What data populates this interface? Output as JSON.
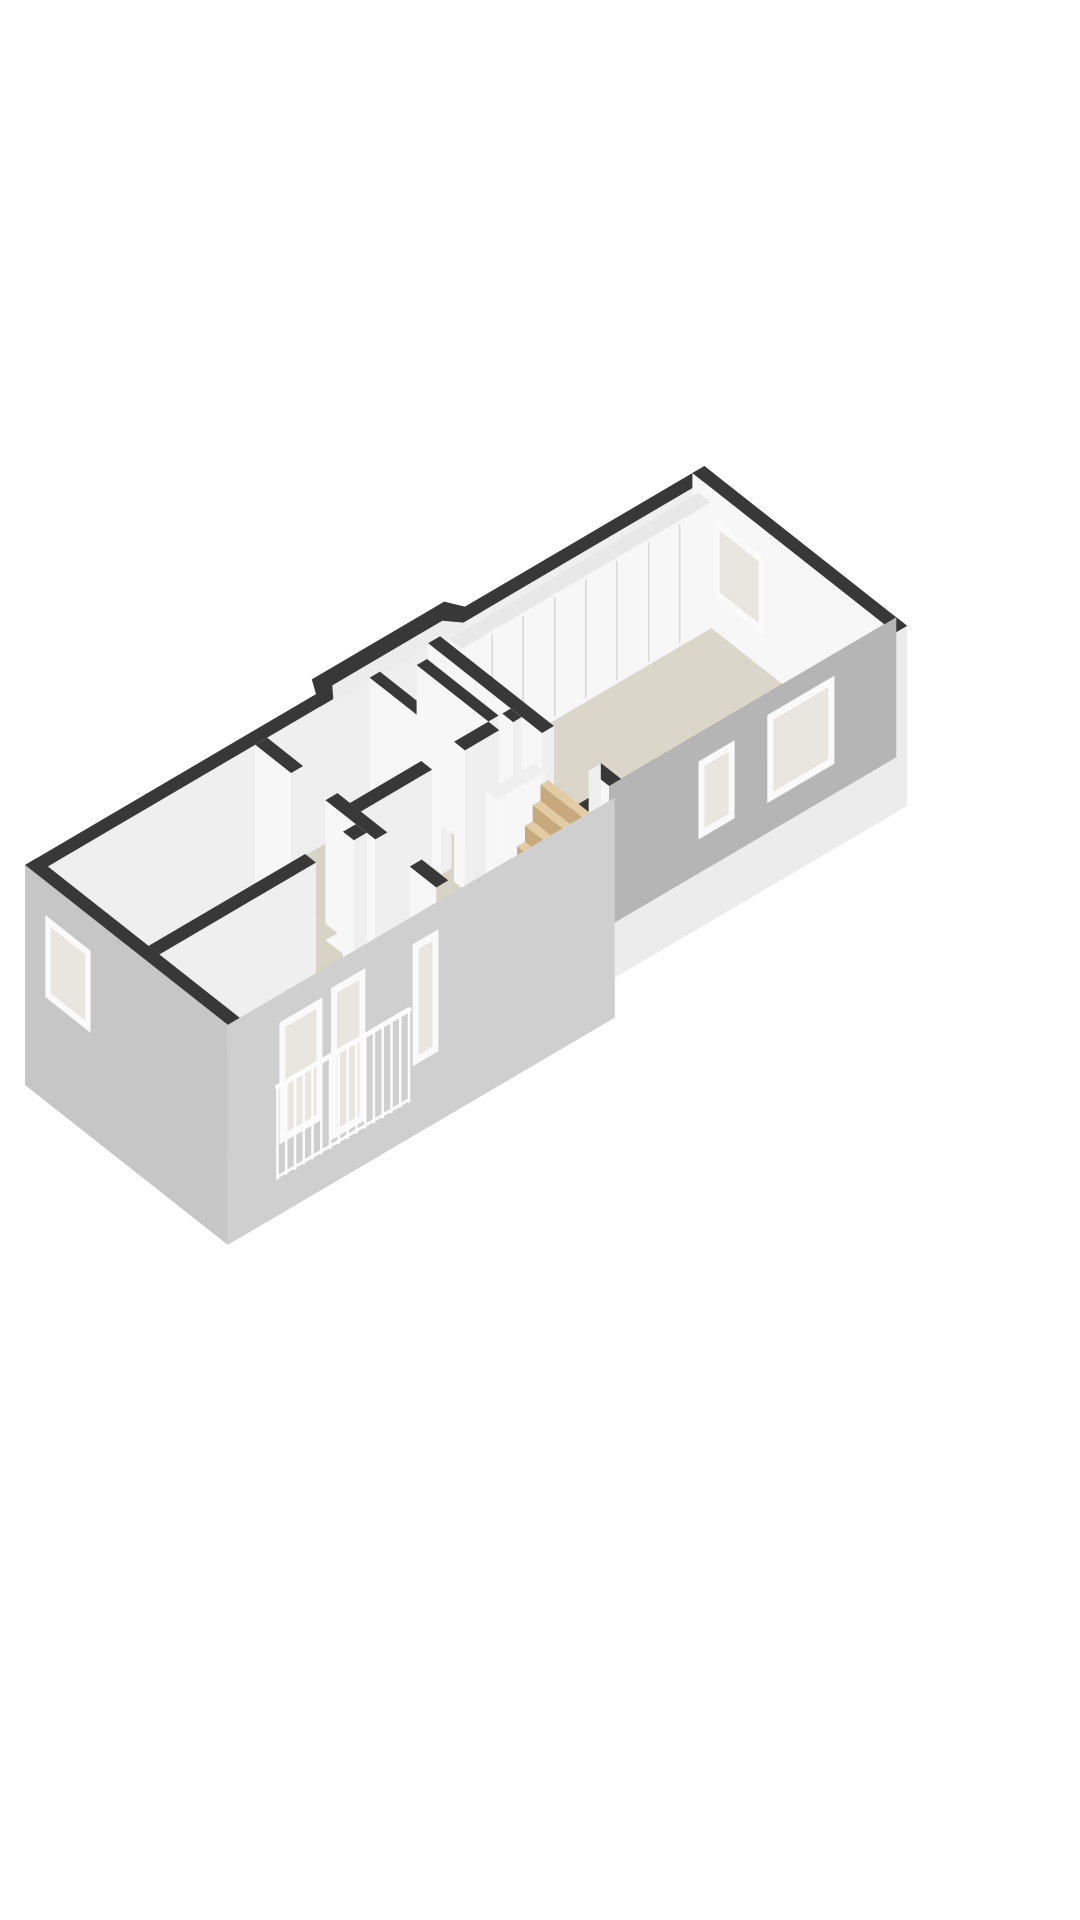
{
  "canvas": {
    "width": 1080,
    "height": 1920,
    "background": "#ffffff"
  },
  "scene": {
    "description": "3d-isometric-floorplan-render",
    "projection": {
      "ox": 25,
      "oy": 1005,
      "ux": 0.86,
      "uy": -0.505,
      "vx": 0.78,
      "vy": 0.615
    },
    "wallHeight": 140,
    "colors": {
      "wallTop": "#383838",
      "whiteA": "#f7f7f7",
      "whiteB": "#efefef",
      "grayIn": "#b5b5b5",
      "outSE": "#cfcfcf",
      "outSW": "#c6c6c6",
      "outLight": "#ececec",
      "floor": "#d7d3c5",
      "floorNE": "#dad6c9",
      "closetTop": "#e8e8e8",
      "landing": "#efefef",
      "seam": "#d8d8d8",
      "frame": "#fafafa",
      "glass": "#e8e6df",
      "stepTop": "#e3cba4",
      "stepFace": "#c8a87d",
      "stepSide": "#bfa077",
      "railing": "#fcfcfc"
    },
    "elements": [
      {
        "name": "nw-facade-wall",
        "t": "box",
        "x": [
          0,
          790
        ],
        "y": [
          0,
          14
        ],
        "faces": [
          {
            "side": "top",
            "c": "wallTop"
          },
          {
            "side": "ymax",
            "c": "whiteB"
          }
        ]
      },
      {
        "name": "bay-window-top",
        "t": "poly",
        "h": 140,
        "c": "wallTop",
        "pts": [
          [
            330,
            14
          ],
          [
            348,
            -16
          ],
          [
            502,
            -16
          ],
          [
            520,
            14
          ]
        ]
      },
      {
        "name": "bay-window-interior",
        "t": "poly",
        "h": 136,
        "c": "outLight",
        "pts": [
          [
            346,
            14
          ],
          [
            360,
            -3
          ],
          [
            488,
            -3
          ],
          [
            504,
            14
          ]
        ]
      },
      {
        "name": "ne-end-wall",
        "t": "box",
        "x": [
          776,
          790
        ],
        "y": [
          0,
          260
        ],
        "faces": [
          {
            "side": "top",
            "c": "wallTop"
          },
          {
            "side": "xmin",
            "c": "whiteA"
          }
        ]
      },
      {
        "name": "ne-room-floor",
        "t": "poly",
        "h": 0,
        "c": "floorNE",
        "pts": [
          [
            470,
            14
          ],
          [
            776,
            14
          ],
          [
            776,
            246
          ],
          [
            470,
            246
          ]
        ]
      },
      {
        "name": "closet-wall",
        "t": "box",
        "x": [
          480,
          770
        ],
        "y": [
          14,
          30
        ],
        "h": [
          6,
          132
        ],
        "faces": [
          {
            "side": "top",
            "c": "closetTop"
          },
          {
            "side": "xmin",
            "c": "whiteA"
          },
          {
            "side": "ymax",
            "c": "whiteA"
          }
        ]
      },
      {
        "name": "closet-door-seams",
        "t": "lines",
        "plane": "ymax",
        "at": 30,
        "us": [
          516,
          552,
          589,
          625,
          661,
          698,
          734
        ],
        "h": [
          10,
          128
        ],
        "c": "seam",
        "w": 1.5
      },
      {
        "name": "ne-end-window",
        "t": "win",
        "plane": "xmin",
        "at": 776,
        "u": [
          28,
          92
        ],
        "h": [
          34,
          112
        ]
      },
      {
        "name": "se-facade-top",
        "t": "poly",
        "h": 140,
        "c": "wallTop",
        "pts": [
          [
            0,
            246
          ],
          [
            790,
            246
          ],
          [
            790,
            260
          ],
          [
            0,
            260
          ]
        ]
      },
      {
        "name": "se-facade-ne-outer",
        "t": "box",
        "x": [
          450,
          790
        ],
        "y": [
          246,
          260
        ],
        "h": [
          -40,
          140
        ],
        "faces": [
          {
            "side": "ymax",
            "c": "outLight"
          }
        ]
      },
      {
        "name": "se-facade-ne-inner",
        "t": "box",
        "x": [
          450,
          790
        ],
        "y": [
          246,
          260
        ],
        "faces": [
          {
            "side": "ymin",
            "c": "grayIn",
            "h": [
              0,
              140
            ]
          }
        ]
      },
      {
        "name": "se-inner-window-large",
        "t": "win",
        "plane": "ymin",
        "at": 246,
        "u": [
          640,
          718
        ],
        "h": [
          30,
          118
        ]
      },
      {
        "name": "se-inner-window-small",
        "t": "win",
        "plane": "ymin",
        "at": 246,
        "u": [
          560,
          602
        ],
        "h": [
          34,
          112
        ]
      },
      {
        "name": "ne-room-partition-a",
        "t": "box",
        "x": [
          456,
          470
        ],
        "y": [
          14,
          160
        ],
        "faces": [
          {
            "side": "top",
            "c": "wallTop"
          },
          {
            "side": "xmin",
            "c": "whiteA"
          },
          {
            "side": "ymax",
            "c": "whiteB"
          }
        ]
      },
      {
        "name": "ne-room-partition-b",
        "t": "box",
        "x": [
          456,
          470
        ],
        "y": [
          220,
          246
        ],
        "faces": [
          {
            "side": "top",
            "c": "wallTop"
          },
          {
            "side": "xmin",
            "c": "whiteA"
          },
          {
            "side": "ymin",
            "c": "whiteB"
          }
        ]
      },
      {
        "name": "ne-room-door-threshold",
        "t": "poly",
        "h": 0,
        "c": "floorNE",
        "pts": [
          [
            456,
            160
          ],
          [
            470,
            160
          ],
          [
            470,
            220
          ],
          [
            456,
            220
          ]
        ]
      },
      {
        "name": "middle-floor",
        "t": "poly",
        "h": 0,
        "c": "floor",
        "pts": [
          [
            269,
            14
          ],
          [
            456,
            14
          ],
          [
            456,
            246
          ],
          [
            269,
            246
          ]
        ]
      },
      {
        "name": "bathroom-partition-a",
        "t": "box",
        "x": [
          388,
          400
        ],
        "y": [
          14,
          106
        ],
        "faces": [
          {
            "side": "top",
            "c": "wallTop"
          },
          {
            "side": "xmin",
            "c": "whiteA"
          },
          {
            "side": "ymax",
            "c": "whiteB"
          }
        ]
      },
      {
        "name": "bathroom-partition-b",
        "t": "box",
        "x": [
          430,
          442
        ],
        "y": [
          28,
          120
        ],
        "faces": [
          {
            "side": "top",
            "c": "wallTop"
          },
          {
            "side": "xmin",
            "c": "whiteA"
          },
          {
            "side": "ymax",
            "c": "whiteB"
          }
        ]
      },
      {
        "name": "hall-partition-a",
        "t": "box",
        "x": [
          269,
          352
        ],
        "y": [
          120,
          134
        ],
        "faces": [
          {
            "side": "top",
            "c": "wallTop"
          },
          {
            "side": "ymax",
            "c": "whiteB"
          }
        ]
      },
      {
        "name": "hall-partition-b",
        "t": "box",
        "x": [
          390,
          430
        ],
        "y": [
          120,
          134
        ],
        "faces": [
          {
            "side": "top",
            "c": "wallTop"
          },
          {
            "side": "ymax",
            "c": "whiteB"
          },
          {
            "side": "xmin",
            "c": "whiteA"
          }
        ]
      },
      {
        "name": "hall-partition-c",
        "t": "box",
        "x": [
          446,
          456
        ],
        "y": [
          120,
          134
        ],
        "faces": [
          {
            "side": "top",
            "c": "wallTop"
          },
          {
            "side": "ymax",
            "c": "whiteB"
          },
          {
            "side": "xmin",
            "c": "whiteA"
          }
        ]
      },
      {
        "name": "hall-door-threshold-a",
        "t": "poly",
        "h": 0,
        "c": "floor",
        "pts": [
          [
            352,
            120
          ],
          [
            390,
            120
          ],
          [
            390,
            134
          ],
          [
            352,
            134
          ]
        ]
      },
      {
        "name": "hall-door-threshold-b",
        "t": "poly",
        "h": 0,
        "c": "floor",
        "pts": [
          [
            430,
            120
          ],
          [
            446,
            120
          ],
          [
            446,
            134
          ],
          [
            430,
            134
          ]
        ]
      },
      {
        "name": "stair-balustrade",
        "t": "box",
        "x": [
          400,
          456
        ],
        "y": [
          150,
          164
        ],
        "h": [
          0,
          104
        ],
        "faces": [
          {
            "side": "top",
            "c": "landing"
          },
          {
            "side": "xmin",
            "c": "whiteA"
          },
          {
            "side": "ymax",
            "c": "whiteA"
          }
        ]
      },
      {
        "name": "stair-step-6",
        "t": "box",
        "x": [
          447,
          456
        ],
        "y": [
          168,
          242
        ],
        "h": [
          0,
          98
        ],
        "faces": [
          {
            "side": "top",
            "c": "stepTop"
          },
          {
            "side": "xmin",
            "c": "stepFace"
          },
          {
            "side": "ymax",
            "c": "stepSide"
          }
        ]
      },
      {
        "name": "stair-step-5",
        "t": "box",
        "x": [
          438,
          447
        ],
        "y": [
          168,
          242
        ],
        "h": [
          0,
          82
        ],
        "faces": [
          {
            "side": "top",
            "c": "stepTop"
          },
          {
            "side": "xmin",
            "c": "stepFace"
          },
          {
            "side": "ymax",
            "c": "stepSide"
          }
        ]
      },
      {
        "name": "stair-step-4",
        "t": "box",
        "x": [
          429,
          438
        ],
        "y": [
          168,
          242
        ],
        "h": [
          0,
          66
        ],
        "faces": [
          {
            "side": "top",
            "c": "stepTop"
          },
          {
            "side": "xmin",
            "c": "stepFace"
          },
          {
            "side": "ymax",
            "c": "stepSide"
          }
        ]
      },
      {
        "name": "stair-step-3",
        "t": "box",
        "x": [
          420,
          429
        ],
        "y": [
          168,
          242
        ],
        "h": [
          0,
          50
        ],
        "faces": [
          {
            "side": "top",
            "c": "stepTop"
          },
          {
            "side": "xmin",
            "c": "stepFace"
          },
          {
            "side": "ymax",
            "c": "stepSide"
          }
        ]
      },
      {
        "name": "stair-step-2",
        "t": "box",
        "x": [
          411,
          420
        ],
        "y": [
          168,
          242
        ],
        "h": [
          0,
          34
        ],
        "faces": [
          {
            "side": "top",
            "c": "stepTop"
          },
          {
            "side": "xmin",
            "c": "stepFace"
          },
          {
            "side": "ymax",
            "c": "stepSide"
          }
        ]
      },
      {
        "name": "stair-step-1",
        "t": "box",
        "x": [
          402,
          411
        ],
        "y": [
          168,
          242
        ],
        "h": [
          0,
          18
        ],
        "faces": [
          {
            "side": "top",
            "c": "stepTop"
          },
          {
            "side": "xmin",
            "c": "stepFace"
          },
          {
            "side": "ymax",
            "c": "stepSide"
          }
        ]
      },
      {
        "name": "sw-partition-a",
        "t": "box",
        "x": [
          255,
          269
        ],
        "y": [
          14,
          60
        ],
        "faces": [
          {
            "side": "top",
            "c": "wallTop"
          },
          {
            "side": "xmin",
            "c": "whiteA"
          },
          {
            "side": "ymax",
            "c": "whiteB"
          }
        ]
      },
      {
        "name": "sw-partition-b",
        "t": "box",
        "x": [
          255,
          269
        ],
        "y": [
          104,
          168
        ],
        "faces": [
          {
            "side": "top",
            "c": "wallTop"
          },
          {
            "side": "xmin",
            "c": "whiteA"
          },
          {
            "side": "ymax",
            "c": "whiteB"
          }
        ]
      },
      {
        "name": "sw-partition-c",
        "t": "box",
        "x": [
          255,
          269
        ],
        "y": [
          212,
          246
        ],
        "faces": [
          {
            "side": "top",
            "c": "wallTop"
          },
          {
            "side": "xmin",
            "c": "whiteA"
          }
        ]
      },
      {
        "name": "sw-door-threshold-a",
        "t": "poly",
        "h": 0,
        "c": "floor",
        "pts": [
          [
            255,
            60
          ],
          [
            269,
            60
          ],
          [
            269,
            104
          ],
          [
            255,
            104
          ]
        ]
      },
      {
        "name": "sw-door-threshold-b",
        "t": "poly",
        "h": 0,
        "c": "floor",
        "pts": [
          [
            255,
            168
          ],
          [
            269,
            168
          ],
          [
            269,
            212
          ],
          [
            255,
            212
          ]
        ]
      },
      {
        "name": "sw-floor",
        "t": "poly",
        "h": 0,
        "c": "floor",
        "pts": [
          [
            14,
            14
          ],
          [
            255,
            14
          ],
          [
            255,
            246
          ],
          [
            14,
            246
          ]
        ]
      },
      {
        "name": "bedroom-partition-a",
        "t": "box",
        "x": [
          14,
          196
        ],
        "y": [
          143,
          157
        ],
        "faces": [
          {
            "side": "top",
            "c": "wallTop"
          },
          {
            "side": "ymax",
            "c": "whiteB"
          }
        ]
      },
      {
        "name": "bedroom-partition-b",
        "t": "box",
        "x": [
          240,
          255
        ],
        "y": [
          143,
          157
        ],
        "faces": [
          {
            "side": "top",
            "c": "wallTop"
          },
          {
            "side": "ymax",
            "c": "whiteB"
          },
          {
            "side": "xmin",
            "c": "whiteA"
          }
        ]
      },
      {
        "name": "bedroom-door-threshold",
        "t": "poly",
        "h": 0,
        "c": "floor",
        "pts": [
          [
            196,
            143
          ],
          [
            240,
            143
          ],
          [
            240,
            157
          ],
          [
            196,
            157
          ]
        ]
      },
      {
        "name": "se-facade-sw-outer",
        "t": "box",
        "x": [
          0,
          450
        ],
        "y": [
          246,
          260
        ],
        "h": [
          -80,
          140
        ],
        "faces": [
          {
            "side": "ymax",
            "c": "outSE"
          }
        ]
      },
      {
        "name": "facade-window-a",
        "t": "win",
        "plane": "ymax",
        "at": 260,
        "u": [
          60,
          110
        ],
        "h": [
          -10,
          112
        ]
      },
      {
        "name": "facade-door",
        "t": "win",
        "plane": "ymax",
        "at": 260,
        "u": [
          120,
          160
        ],
        "h": [
          -36,
          116
        ]
      },
      {
        "name": "facade-window-b",
        "t": "win",
        "plane": "ymax",
        "at": 260,
        "u": [
          215,
          245
        ],
        "h": [
          -10,
          112
        ]
      },
      {
        "name": "balcony-railing",
        "t": "rail",
        "at": 263,
        "x": [
          55,
          208
        ],
        "top": 52,
        "bot": -40,
        "n": 16
      },
      {
        "name": "sw-end-facade",
        "t": "box",
        "x": [
          0,
          14
        ],
        "y": [
          0,
          260
        ],
        "h": [
          -80,
          140
        ],
        "faces": [
          {
            "side": "top",
            "c": "wallTop"
          },
          {
            "side": "xmin",
            "c": "outSW"
          }
        ]
      },
      {
        "name": "sw-end-window",
        "t": "win",
        "plane": "xmin",
        "at": 0,
        "u": [
          26,
          84
        ],
        "h": [
          24,
          106
        ]
      }
    ]
  }
}
